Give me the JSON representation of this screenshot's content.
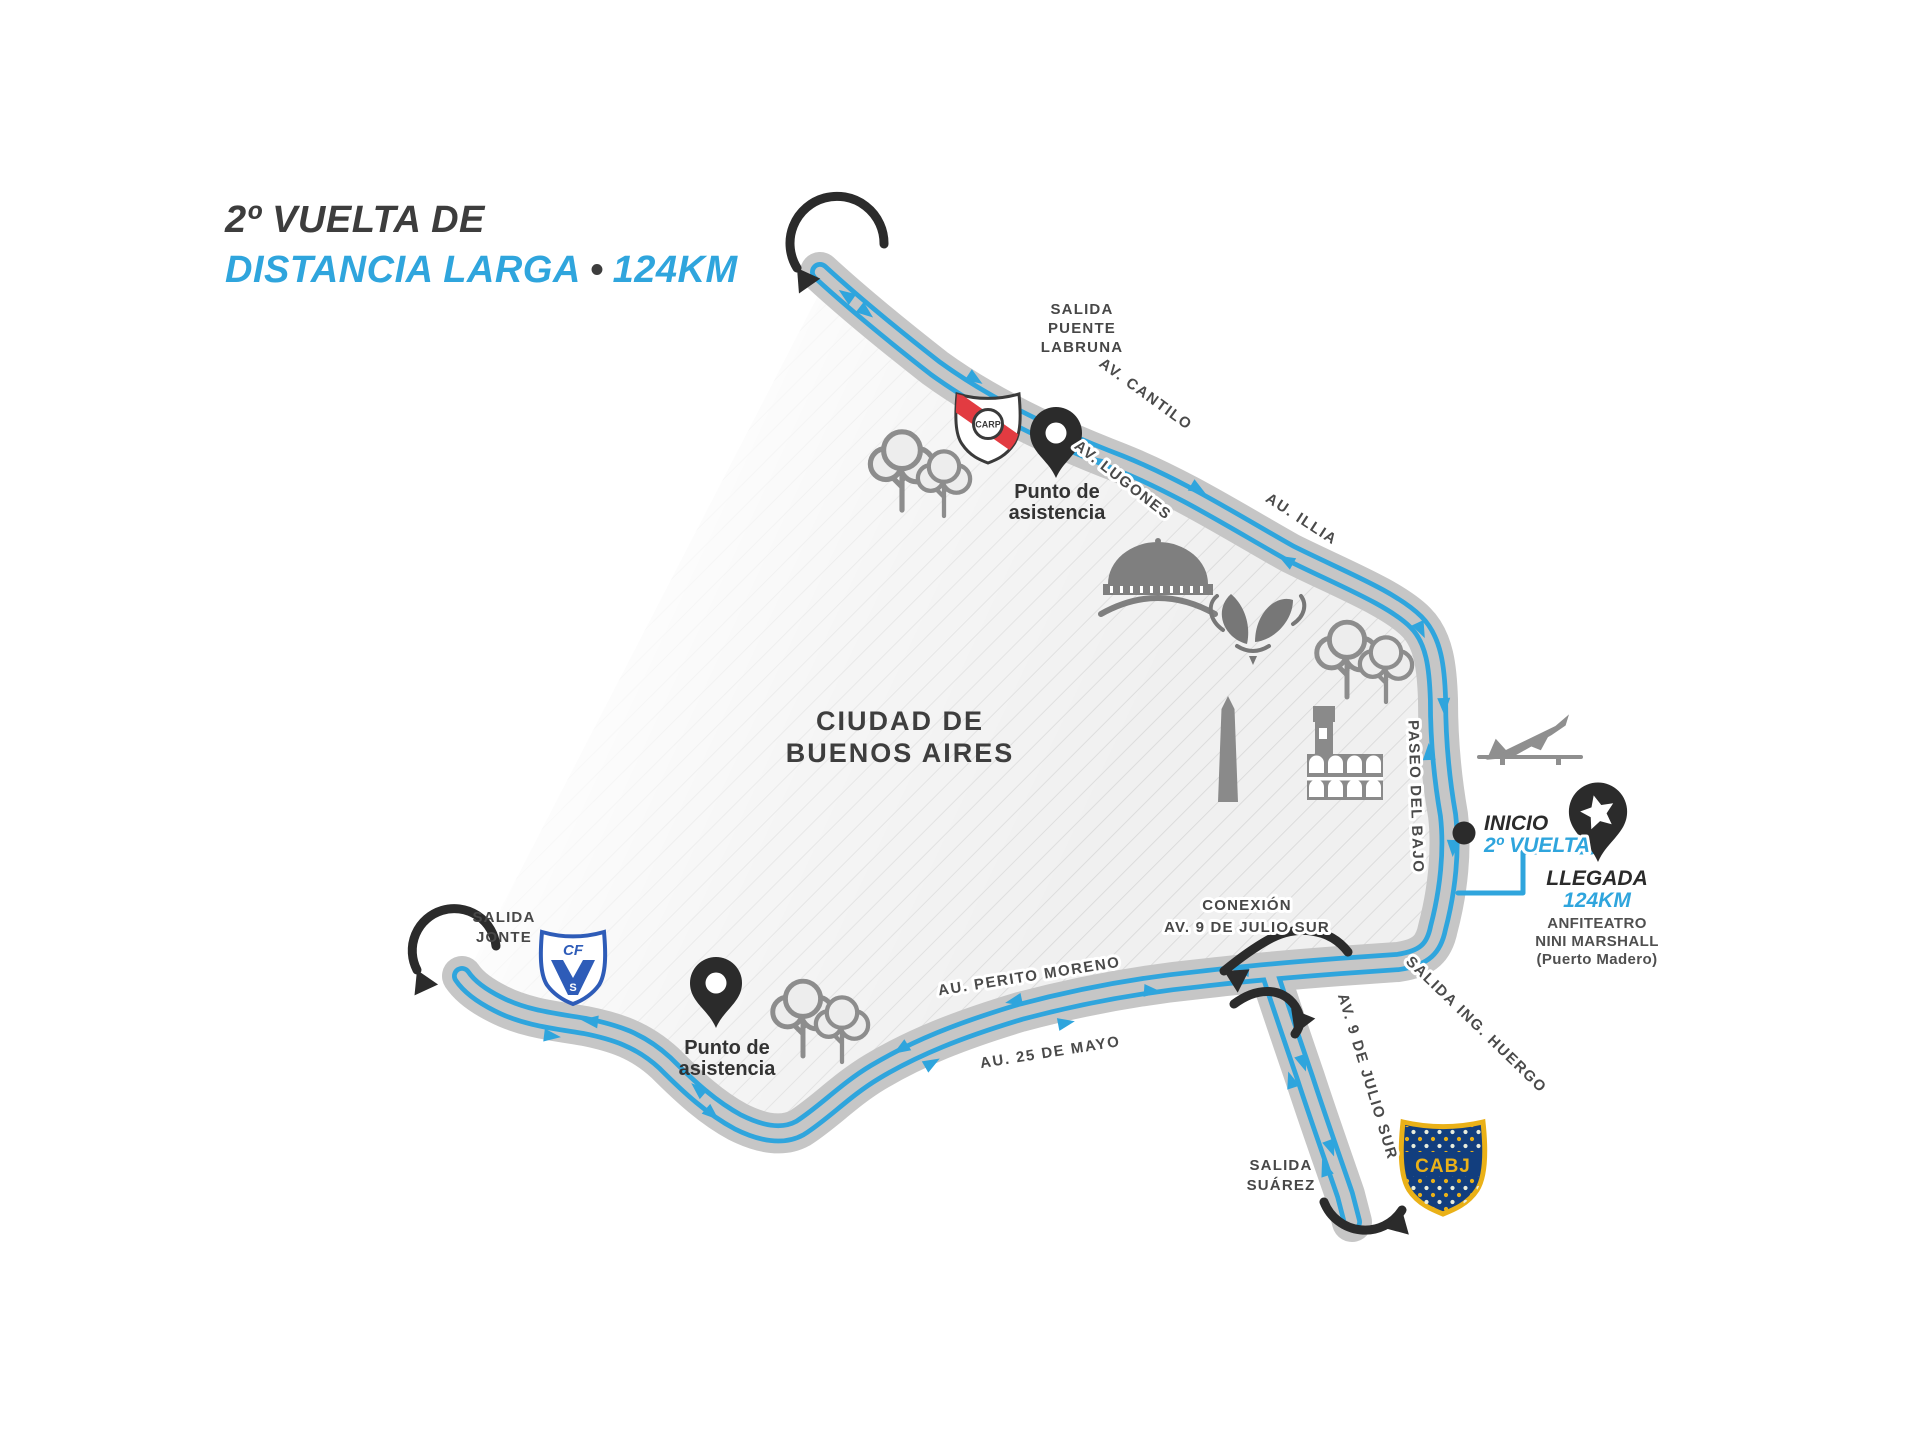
{
  "title": {
    "line1": "2º VUELTA DE",
    "line2_part1": "DISTANCIA LARGA",
    "separator": "•",
    "line2_part2": "124KM"
  },
  "region": {
    "line1": "CIUDAD DE",
    "line2": "BUENOS AIRES"
  },
  "streets": {
    "cantilo": "AV. CANTILO",
    "lugones": "AV. LUGONES",
    "illia": "AU. ILLIA",
    "paseo_del_bajo": "PASEO DEL BAJO",
    "perito_moreno": "AU. PERITO MORENO",
    "veinticinco_de_mayo": "AU. 25 DE MAYO",
    "nueve_de_julio_sur": "AV. 9 DE JULIO SUR",
    "salida_ing_huergo": "SALIDA ING. HUERGO"
  },
  "points": {
    "salida_puente_labruna": [
      "SALIDA",
      "PUENTE",
      "LABRUNA"
    ],
    "salida_jonte": [
      "SALIDA",
      "JONTE"
    ],
    "salida_suarez": [
      "SALIDA",
      "SUÁREZ"
    ],
    "conexion": [
      "CONEXIÓN",
      "AV. 9 DE JULIO SUR"
    ],
    "inicio": {
      "label": "INICIO",
      "sublabel": "2º VUELTA"
    },
    "llegada": {
      "label": "LLEGADA",
      "sublabel": "124KM",
      "venue": [
        "ANFITEATRO",
        "NINI MARSHALL",
        "(Puerto Madero)"
      ]
    },
    "asistencia_norte": {
      "line1": "Punto de",
      "line2": "asistencia"
    },
    "asistencia_sur": {
      "line1": "Punto de",
      "line2": "asistencia"
    }
  },
  "crests": {
    "river_plate": "CARP",
    "velez_cf": "CF",
    "velez_s": "S",
    "boca_juniors": "CABJ"
  },
  "colors": {
    "route_blue": "#2fa5dd",
    "road_gray": "#c6c6c6",
    "text_dark": "#3d3d3d",
    "icon_gray": "#8d8d8d",
    "marker_black": "#2b2b2b",
    "boca_blue": "#123e7e",
    "boca_gold": "#eab118",
    "river_red": "#e23b41",
    "velez_blue": "#2e5cb8"
  }
}
